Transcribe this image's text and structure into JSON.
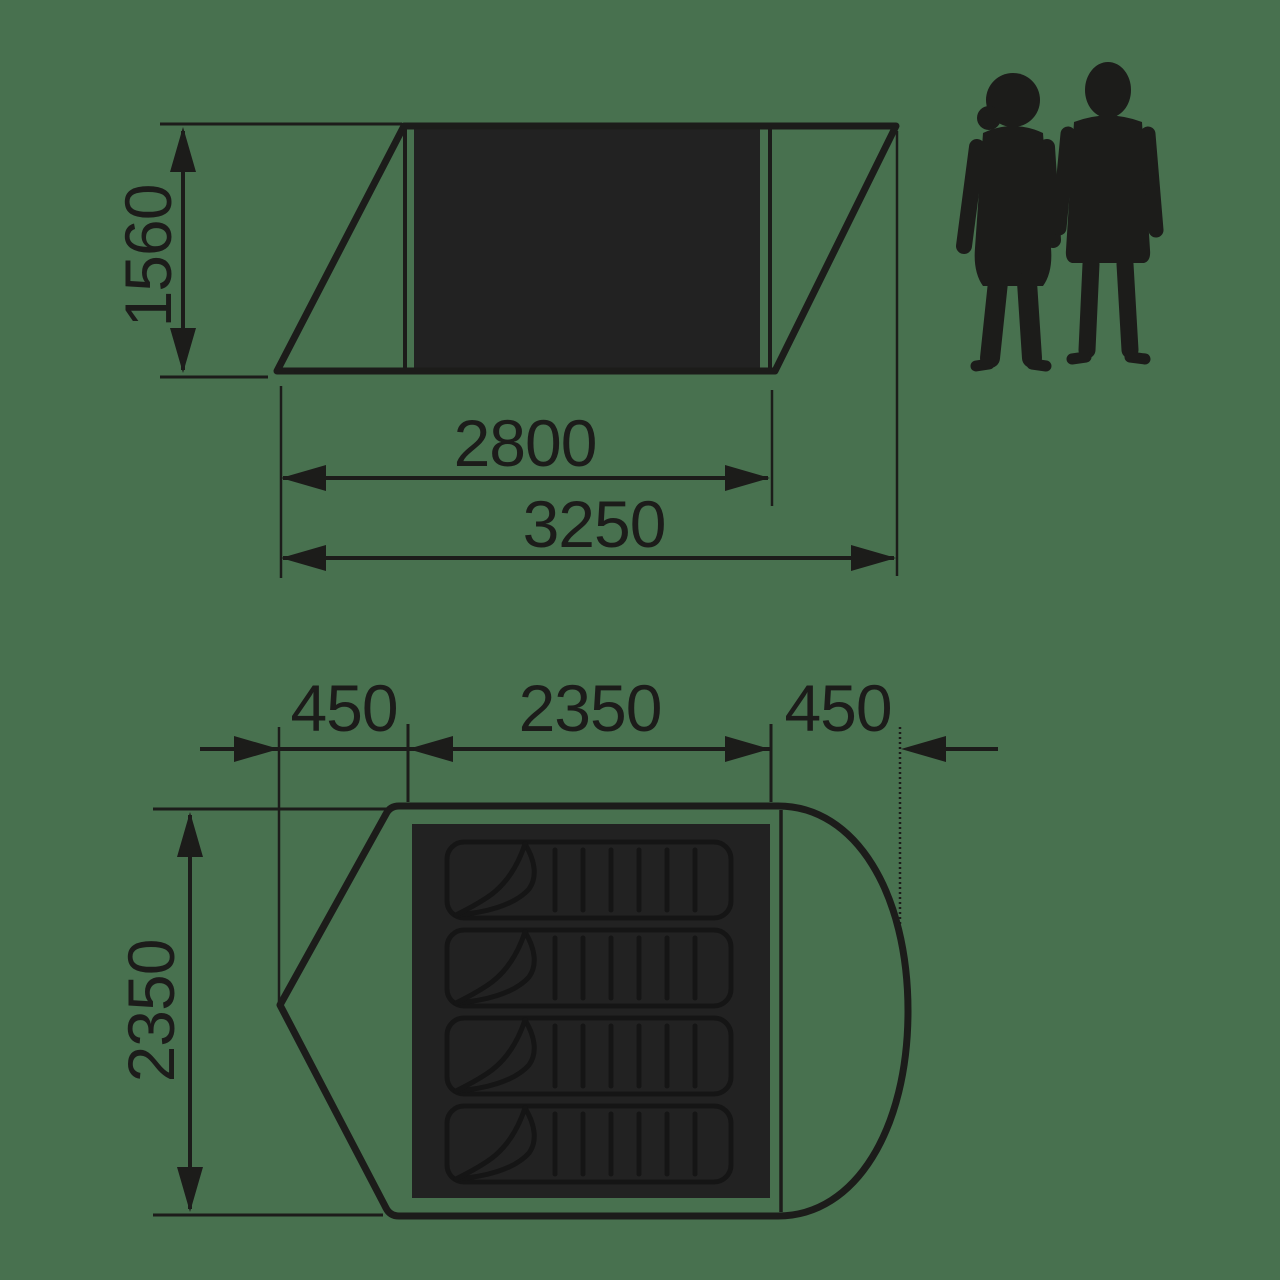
{
  "colors": {
    "background": "#48714f",
    "ink": "#1c1c1a",
    "panel_dark": "#222222",
    "bag_line": "#151515"
  },
  "side_view": {
    "title": "tent-side-elevation",
    "height_label": "1560",
    "inner_width_label": "2800",
    "outer_width_label": "3250"
  },
  "top_view": {
    "title": "tent-floor-plan",
    "porch_left_label": "450",
    "inner_length_label": "2350",
    "porch_right_label": "450",
    "width_label": "2350",
    "sleeping_bag_count": 4
  },
  "figures": {
    "left": "woman-silhouette",
    "right": "man-silhouette"
  }
}
